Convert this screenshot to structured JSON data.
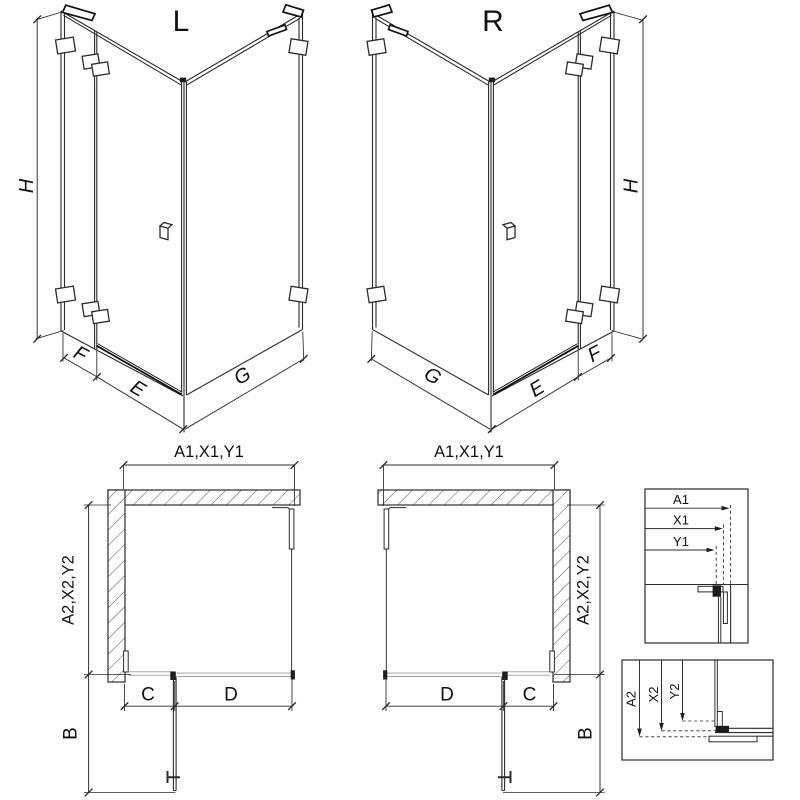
{
  "colors": {
    "line": "#2b2b2b",
    "dark": "#111111",
    "gray": "#999999",
    "background": "#ffffff"
  },
  "iso_left": {
    "label": "L",
    "height": "H",
    "fixed": "F",
    "door": "E",
    "side": "G"
  },
  "iso_right": {
    "label": "R",
    "height": "H",
    "fixed": "F",
    "door": "E",
    "side": "G"
  },
  "plan_left": {
    "width": "A1,X1,Y1",
    "depth": "A2,X2,Y2",
    "c": "C",
    "d": "D",
    "b": "B"
  },
  "plan_right": {
    "width": "A1,X1,Y1",
    "depth": "A2,X2,Y2",
    "c": "C",
    "d": "D",
    "b": "B"
  },
  "detail_width": {
    "a1": "A1",
    "x1": "X1",
    "y1": "Y1"
  },
  "detail_depth": {
    "a2": "A2",
    "x2": "X2",
    "y2": "Y2"
  }
}
